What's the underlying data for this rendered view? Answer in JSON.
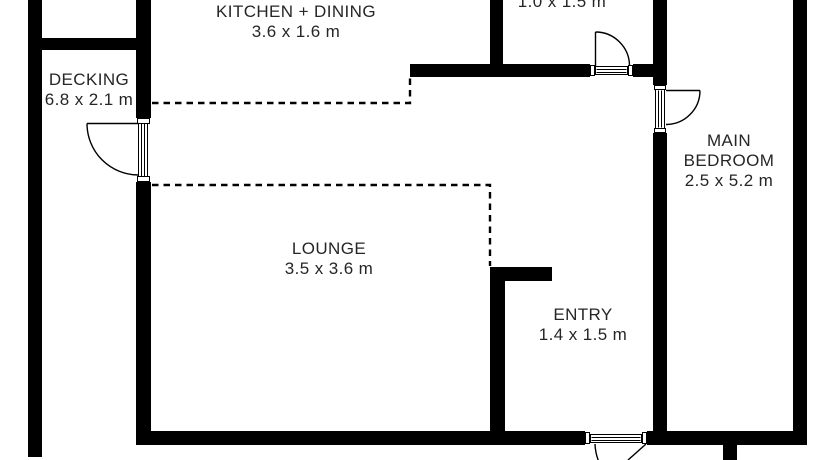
{
  "rooms": [
    {
      "id": "kitchen-dining",
      "name": "KITCHEN + DINING",
      "dims": "3.6 x 1.6 m"
    },
    {
      "id": "utility",
      "name": "",
      "dims": "1.0 x 1.5 m"
    },
    {
      "id": "decking",
      "name": "DECKING",
      "dims": "6.8 x 2.1 m"
    },
    {
      "id": "main-bedroom",
      "name": "MAIN BEDROOM",
      "dims": "2.5 x 5.2 m"
    },
    {
      "id": "lounge",
      "name": "LOUNGE",
      "dims": "3.5 x 3.6 m"
    },
    {
      "id": "entry",
      "name": "ENTRY",
      "dims": "1.4 x 1.5 m"
    }
  ],
  "colors": {
    "wall": "#000000",
    "background": "#ffffff",
    "text": "#262626"
  }
}
